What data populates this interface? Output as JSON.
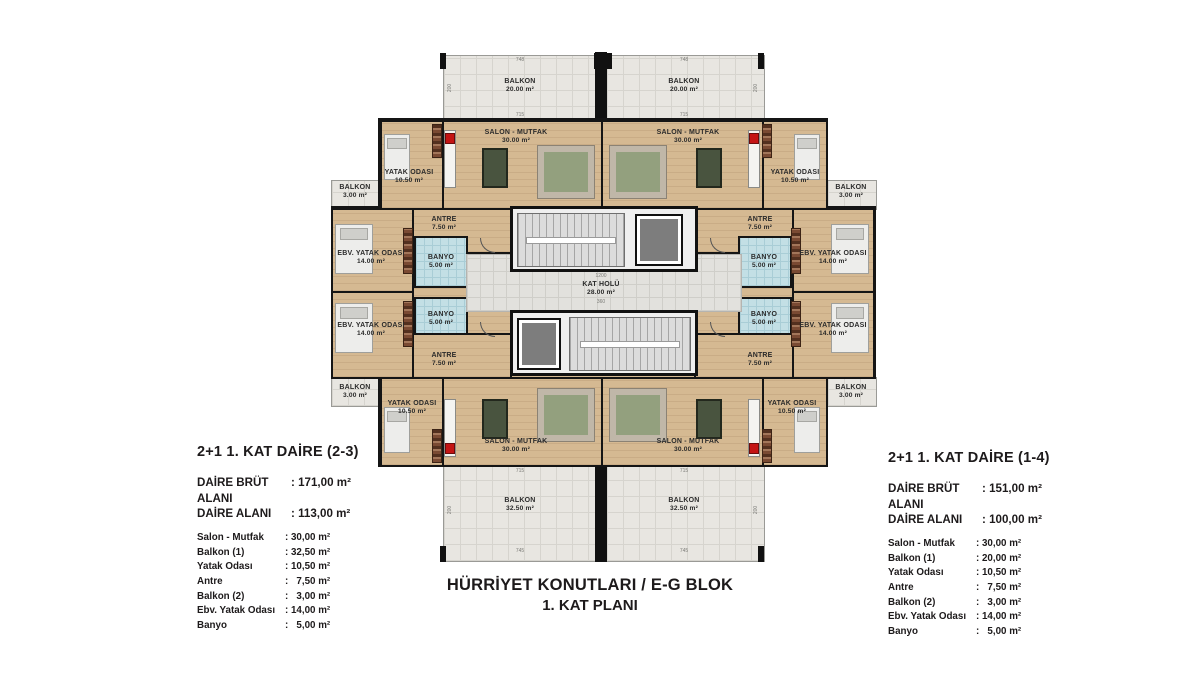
{
  "plan": {
    "rooms": {
      "balkon_top": {
        "name": "BALKON",
        "area": "20.00 m²"
      },
      "balkon_buyuk": {
        "name": "BALKON",
        "area": "32.50 m²"
      },
      "balkon_kucuk": {
        "name": "BALKON",
        "area": "3.00 m²"
      },
      "salon": {
        "name": "SALON - MUTFAK",
        "area": "30.00 m²"
      },
      "yatak": {
        "name": "YATAK ODASI",
        "area": "10.50 m²"
      },
      "antre": {
        "name": "ANTRE",
        "area": "7.50 m²"
      },
      "ebv": {
        "name": "EBV. YATAK ODASI",
        "area": "14.00 m²"
      },
      "banyo": {
        "name": "BANYO",
        "area": "5.00 m²"
      },
      "hol": {
        "name": "KAT HOLÜ",
        "area": "28.00 m²"
      }
    },
    "dims": {
      "top_width": "748",
      "salon_width": "715",
      "bottom_width": "745",
      "balcony_depth": "200",
      "hall_length": "1200",
      "hall_width": "360"
    }
  },
  "info_left": {
    "title": "2+1 1. KAT DAİRE (2-3)",
    "gross_label": "DAİRE BRÜT ALANI",
    "gross_value": ": 171,00 m²",
    "net_label": "DAİRE ALANI",
    "net_value": ": 113,00 m²",
    "rows": [
      {
        "label": "Salon - Mutfak",
        "value": ": 30,00 m²"
      },
      {
        "label": "Balkon (1)",
        "value": ": 32,50 m²"
      },
      {
        "label": "Yatak Odası",
        "value": ": 10,50 m²"
      },
      {
        "label": "Antre",
        "value": ":   7,50 m²"
      },
      {
        "label": "Balkon (2)",
        "value": ":   3,00 m²"
      },
      {
        "label": "Ebv. Yatak Odası",
        "value": ": 14,00 m²"
      },
      {
        "label": "Banyo",
        "value": ":   5,00 m²"
      }
    ]
  },
  "info_right": {
    "title": "2+1 1. KAT DAİRE (1-4)",
    "gross_label": "DAİRE BRÜT ALANI",
    "gross_value": ": 151,00 m²",
    "net_label": "DAİRE ALANI",
    "net_value": ": 100,00 m²",
    "rows": [
      {
        "label": "Salon - Mutfak",
        "value": ": 30,00 m²"
      },
      {
        "label": "Balkon (1)",
        "value": ": 20,00 m²"
      },
      {
        "label": "Yatak Odası",
        "value": ": 10,50 m²"
      },
      {
        "label": "Antre",
        "value": ":   7,50 m²"
      },
      {
        "label": "Balkon (2)",
        "value": ":   3,00 m²"
      },
      {
        "label": "Ebv. Yatak Odası",
        "value": ": 14,00 m²"
      },
      {
        "label": "Banyo",
        "value": ":   5,00 m²"
      }
    ]
  },
  "footer": {
    "line1": "HÜRRİYET KONUTLARI / E-G BLOK",
    "line2": "1. KAT PLANI"
  },
  "colors": {
    "wall": "#151515",
    "wood_floor": "#d5b992",
    "balcony_tile": "#e8e6e1",
    "bathroom_tile": "#c3dfe5",
    "stair": "#dcdcdc",
    "elevator": "#7d7d7d",
    "stove": "#c41414"
  }
}
